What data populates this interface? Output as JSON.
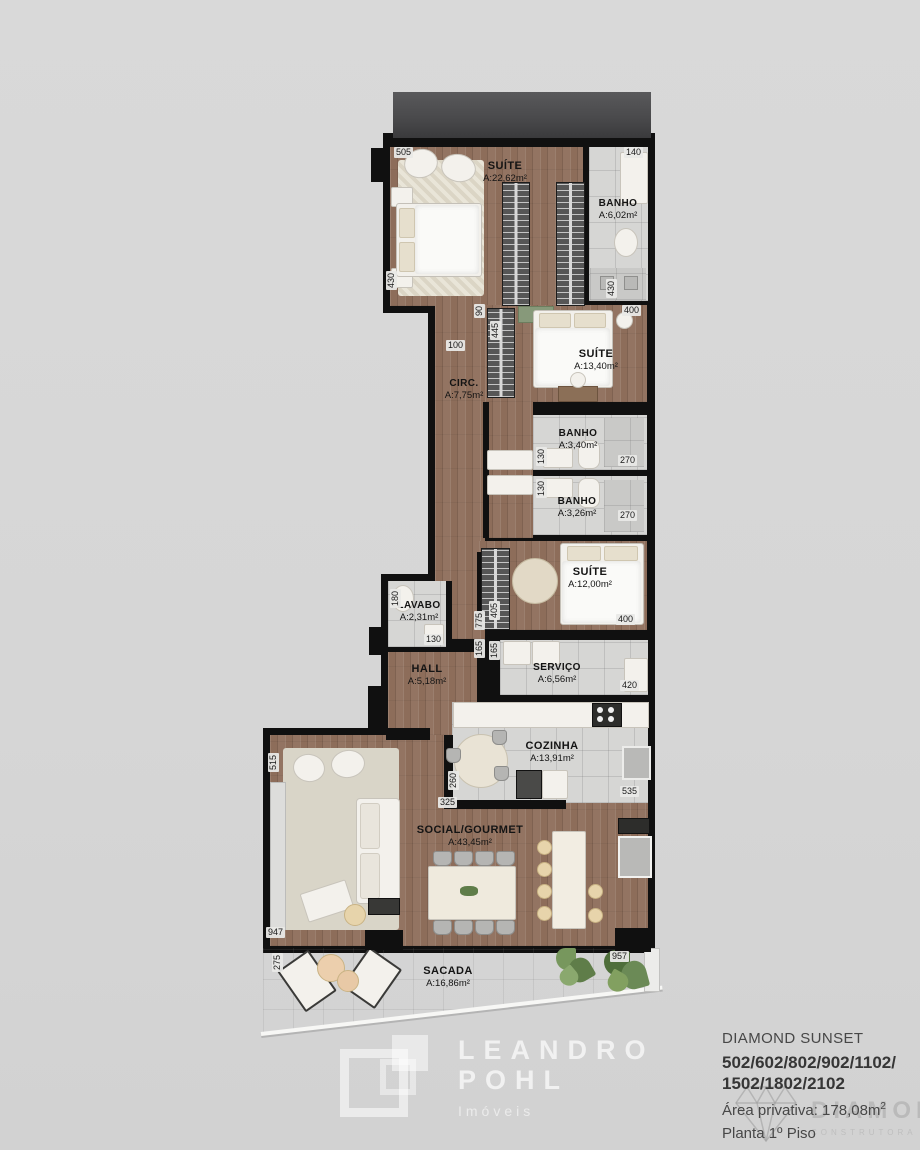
{
  "plan_title": "Floor plan",
  "rooms": {
    "suite1": {
      "name": "SUÍTE",
      "area": "A:22,62m²"
    },
    "banho1": {
      "name": "BANHO",
      "area": "A:6,02m²"
    },
    "suite2": {
      "name": "SUÍTE",
      "area": "A:13,40m²"
    },
    "circ": {
      "name": "CIRC.",
      "area": "A:7,75m²"
    },
    "banho2": {
      "name": "BANHO",
      "area": "A:3,40m²"
    },
    "banho3": {
      "name": "BANHO",
      "area": "A:3,26m²"
    },
    "suite3": {
      "name": "SUÍTE",
      "area": "A:12,00m²"
    },
    "lavabo": {
      "name": "LAVABO",
      "area": "A:2,31m²"
    },
    "hall": {
      "name": "HALL",
      "area": "A:5,18m²"
    },
    "servico": {
      "name": "SERVIÇO",
      "area": "A:6,56m²"
    },
    "cozinha": {
      "name": "COZINHA",
      "area": "A:13,91m²"
    },
    "social": {
      "name": "SOCIAL/GOURMET",
      "area": "A:43,45m²"
    },
    "sacada": {
      "name": "SACADA",
      "area": "A:16,86m²"
    }
  },
  "dimensions": {
    "suite1_top": "505",
    "banho1_top": "140",
    "suite1_left": "430",
    "banho1_right": "430",
    "suite2_top_right": "400",
    "circ_door": "90",
    "circ_left": "100",
    "suite2_wardrobe": "445",
    "banho2_left": "130",
    "banho2_right": "270",
    "banho3_left": "130",
    "banho3_right": "270",
    "suite3_bottom_right": "400",
    "lavabo_left": "180",
    "lavabo_bottom": "130",
    "corridor_405": "405",
    "corridor_775": "775",
    "hall_165a": "165",
    "hall_165b": "165",
    "servico_right": "420",
    "cozinha_right": "535",
    "social_left": "515",
    "cozinha_table": "260",
    "cozinha_bottom": "325",
    "social_bottom": "947",
    "sacada_left": "275",
    "sacada_right": "957"
  },
  "footer": {
    "project": "DIAMOND SUNSET",
    "units_line1": "502/602/802/902/1102/",
    "units_line2": "1502/1802/2102",
    "private_area_label": "Área privativa: 178,08m",
    "private_area_sup": "2",
    "floor_label": "Planta 1º Piso"
  },
  "watermarks": {
    "realtor_name1": "LEANDRO",
    "realtor_name2": "POHL",
    "realtor_tagline": "Imóveis",
    "builder_name": "DIAMOND",
    "builder_tagline": "CONSTRUTORA"
  },
  "colors": {
    "background": "#d9d9d9",
    "wall": "#101010",
    "wood_floor": "#8d6d5a",
    "tile_floor": "#d6d6d4",
    "roof_slab": "#4a4a4c"
  }
}
